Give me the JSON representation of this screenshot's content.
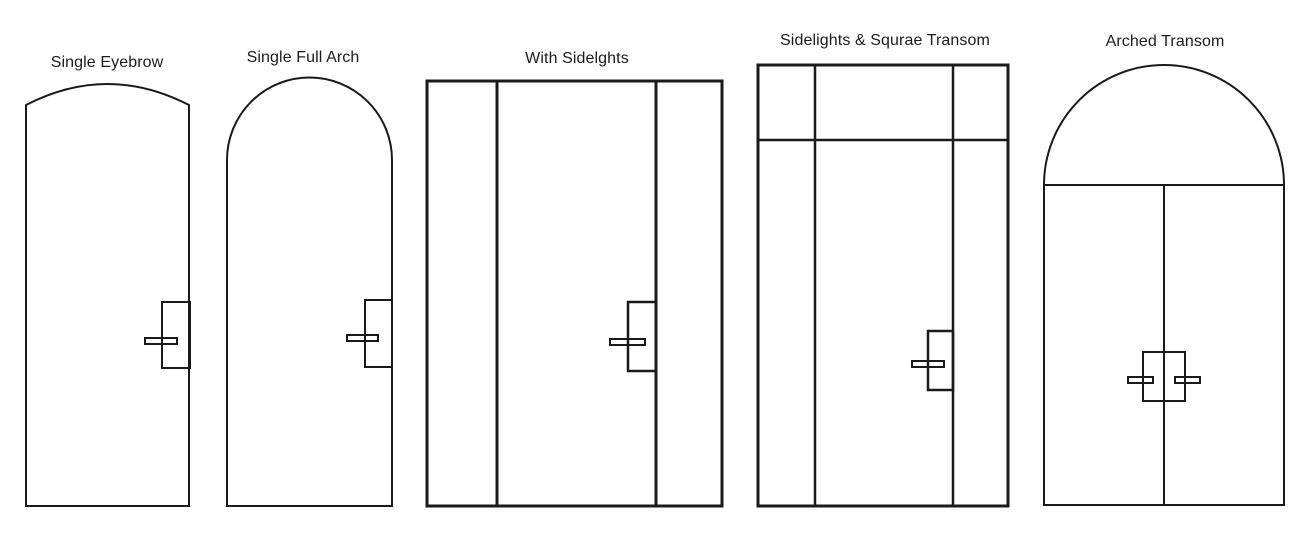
{
  "figure": {
    "background_color": "#ffffff",
    "line_color": "#1a1a1a",
    "text_color": "#1c1c1c"
  },
  "doors": [
    {
      "id": "single-eyebrow",
      "label": "Single Eyebrow",
      "style": "single door with eyebrow arch top",
      "handle": "right-side lever"
    },
    {
      "id": "single-full-arch",
      "label": "Single Full Arch",
      "style": "single door with full semicircular arch top",
      "handle": "right-side lever"
    },
    {
      "id": "with-sidelights",
      "label": "With Sidelghts",
      "style": "rectangular door with left and right sidelights",
      "handle": "right-side lever on center panel"
    },
    {
      "id": "sidelights-square-transom",
      "label": "Sidelights & Squrae Transom",
      "style": "door with sidelights and square transom band",
      "handle": "right-side lever on center panel"
    },
    {
      "id": "arched-transom",
      "label": "Arched Transom",
      "style": "double doors with semicircular arched transom",
      "handle": "double levers at center meeting stile"
    }
  ]
}
